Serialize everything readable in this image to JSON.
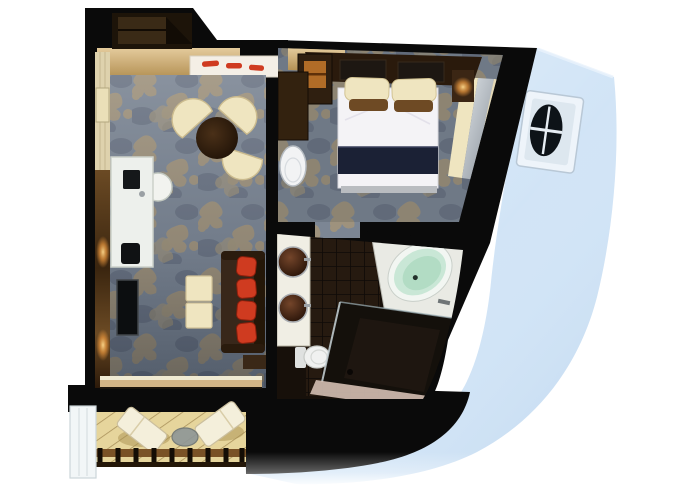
{
  "scene": {
    "type": "cruise-suite-floorplan-render",
    "description": "Top-down 3D cutaway floor plan of a ship suite: entry hall, living room with damask carpet, bedroom, bathroom and private balcony, set against a pale blue ship hull with one porthole window",
    "background": "#ffffff"
  },
  "colors": {
    "wall": "#0a0a0a",
    "hull": "#cfe3f6",
    "carpet": "#7c8694",
    "carpet_motif": "#a2947a",
    "wood_floor": "#d3b586",
    "wall_wood": "#5d3f1f",
    "cream": "#efe5c0",
    "sofa_brown": "#38271a",
    "pillow_red": "#cf3b20",
    "duvet_white": "#f4f3f6",
    "bed_navy": "#1b2135",
    "tub_mint": "#c9e7d6",
    "tile_dark": "#261a10",
    "vanity_white": "#f0eee4",
    "deck_tan": "#e6d59c",
    "mirror_gray": "#c3cad0",
    "porthole_dark": "#0d1318",
    "glass_partition": "#f2f6f7"
  },
  "rooms": {
    "entry": {
      "name": "entry-hall",
      "furniture": [
        "wardrobe-closet",
        "white-sideboard",
        "red-trays"
      ]
    },
    "living_room": {
      "name": "living-room",
      "furniture": [
        "writing-desk",
        "desk-chair",
        "laptop",
        "round-dining-table",
        "three-cream-tub-chairs",
        "two-cream-ottomans",
        "sofa-with-four-red-cushions",
        "wall-tv",
        "wood-panel-wall"
      ]
    },
    "bedroom": {
      "name": "bedroom",
      "furniture": [
        "double-bed-white-duvet-navy-runner",
        "two-cream-pillows",
        "headboard-canopy-shelf",
        "nightstands-with-lit-lamps",
        "minibar-cabinet",
        "vanity-desk",
        "white-oval-chair",
        "mirrored-wardrobe-panels"
      ]
    },
    "bathroom": {
      "name": "bathroom",
      "furniture": [
        "double-vessel-sink-vanity",
        "toilet",
        "oval-bathtub-mint-interior",
        "walk-in-glass-shower",
        "dark-tile-floor"
      ]
    },
    "balcony": {
      "name": "balcony",
      "furniture": [
        "two-white-loungers",
        "round-side-table",
        "slatted-railing",
        "glass-privacy-partition",
        "teak-deck"
      ]
    }
  },
  "hull": {
    "name": "ship-hull-exterior",
    "features": [
      "porthole-window"
    ]
  }
}
